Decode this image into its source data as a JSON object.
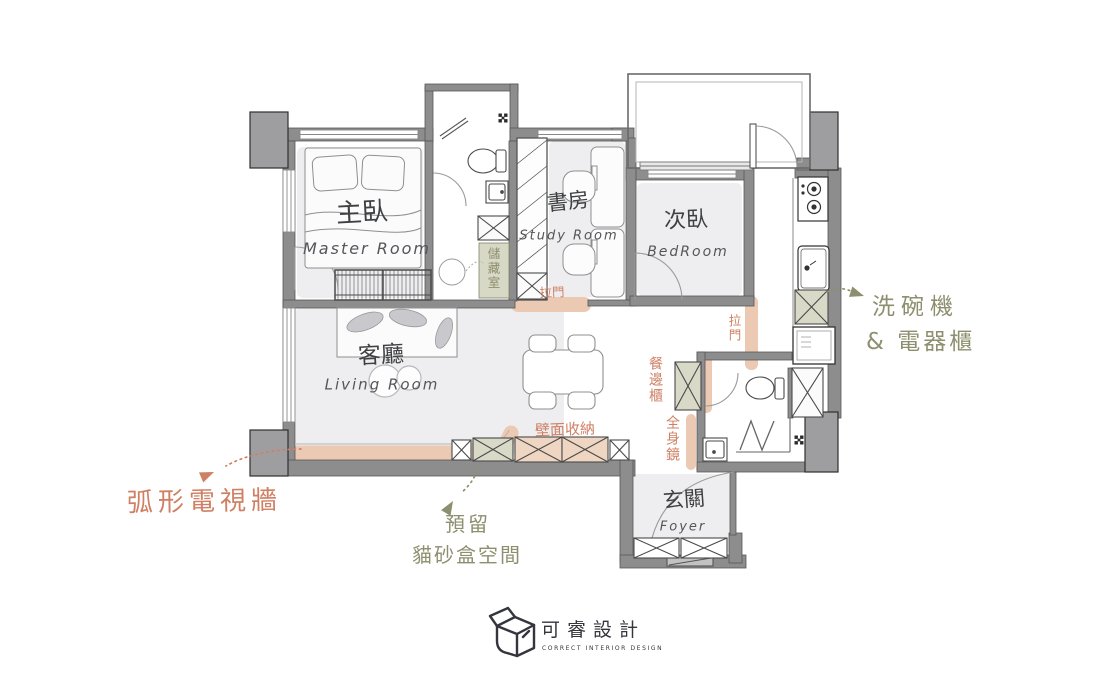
{
  "rooms": {
    "master": {
      "zh": "主臥",
      "en": "Master Room"
    },
    "study": {
      "zh": "書房",
      "en": "Study Room"
    },
    "bedroom": {
      "zh": "次臥",
      "en": "BedRoom"
    },
    "living": {
      "zh": "客廳",
      "en": "Living Room"
    },
    "foyer": {
      "zh": "玄關",
      "en": "Foyer"
    }
  },
  "labels": {
    "storage": "儲藏室",
    "sliding_door_study": "拉門",
    "sliding_door_bedroom": "拉門",
    "wall_storage": "壁面收納",
    "sideboard": "餐邊櫃",
    "full_length_mirror": "全身鏡"
  },
  "annotations": {
    "tv_wall": "弧形電視牆",
    "cat_line1": "預留",
    "cat_line2": "貓砂盒空間",
    "appliance_line1": "洗碗機",
    "appliance_line2": "& 電器櫃"
  },
  "logo": {
    "name": "可睿設計",
    "tagline": "CORRECT INTERIOR DESIGN"
  },
  "palette": {
    "annotation_orange": "#cf8064",
    "annotation_olive": "#8e8f6e",
    "highlight_peach": "#ecc9b2",
    "cabinet_peach": "#efd6c3",
    "cabinet_green": "#d9d9c8",
    "wall_gray": "#8d8d8d",
    "floor_gray": "#eeeef0",
    "logo_ink": "#34353d"
  }
}
